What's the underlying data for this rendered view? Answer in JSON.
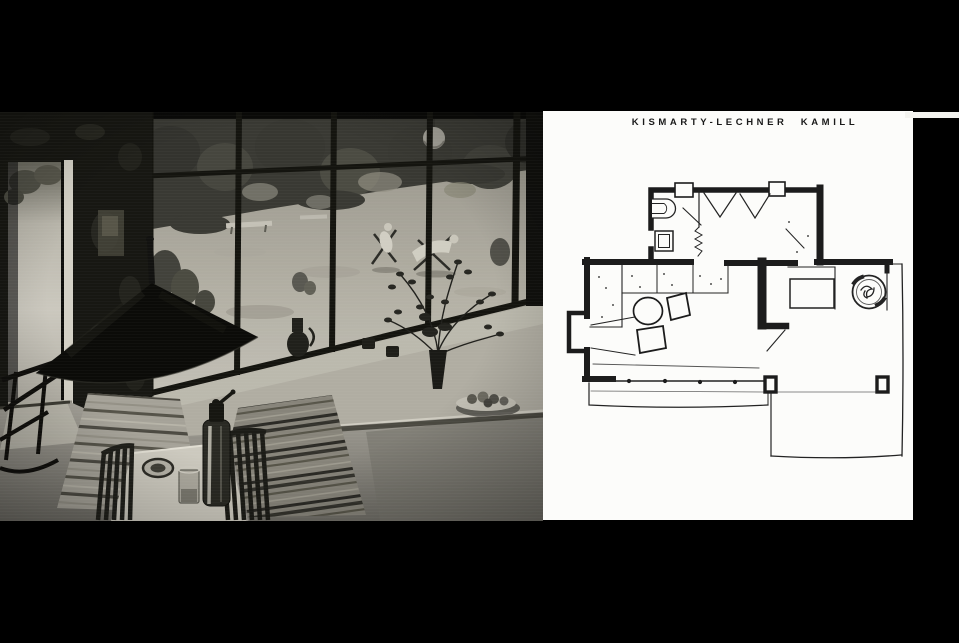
{
  "page": {
    "background_color": "#000000",
    "kind": "archival spread: interior photograph beside hand-drawn floor plan"
  },
  "plan_panel": {
    "title": "KISMARTY-LECHNER KAMILL",
    "paper_color": "#fcfcfa",
    "ink_color": "#1c1c1c"
  },
  "photo_panel": {
    "medium": "black-and-white photograph",
    "dominant_colors": {
      "shadow": "#141411",
      "stone_wall": "#17171.2",
      "meadow": "#b3b0a7",
      "floor": "#96938a",
      "highlight": "#cfccc1"
    }
  }
}
